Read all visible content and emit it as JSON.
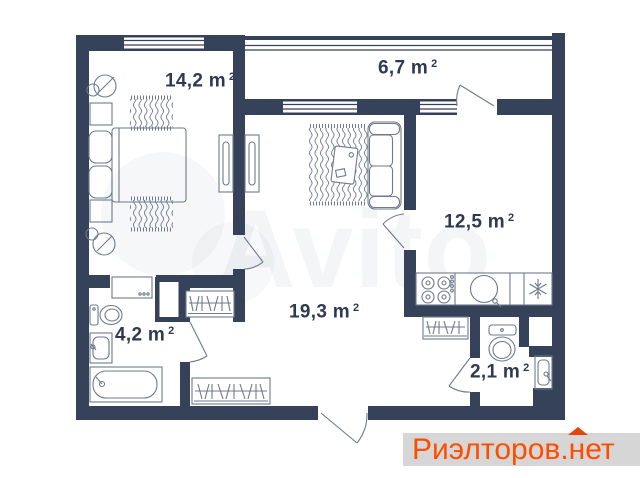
{
  "page": {
    "background": "#ffffff"
  },
  "plan": {
    "colors": {
      "wall": "#36415A",
      "furniture": "#6E7A8C",
      "label_text": "#2F3A52"
    },
    "rooms": [
      {
        "name": "bedroom",
        "area": "14,2 m",
        "sup": "2"
      },
      {
        "name": "balcony",
        "area": "6,7 m",
        "sup": "2"
      },
      {
        "name": "kitchen",
        "area": "12,5 m",
        "sup": "2"
      },
      {
        "name": "living-hall",
        "area": "19,3 m",
        "sup": "2"
      },
      {
        "name": "bathroom",
        "area": "4,2 m",
        "sup": "2"
      },
      {
        "name": "wc",
        "area": "2,1 m",
        "sup": "2"
      }
    ]
  },
  "watermark": {
    "text": "Avito"
  },
  "brand": {
    "prefix": "Риэлторов.",
    "suffix": "нет",
    "color": "#FF4D00",
    "roof_color": "#E8430A",
    "background": "#D6D6D6"
  }
}
